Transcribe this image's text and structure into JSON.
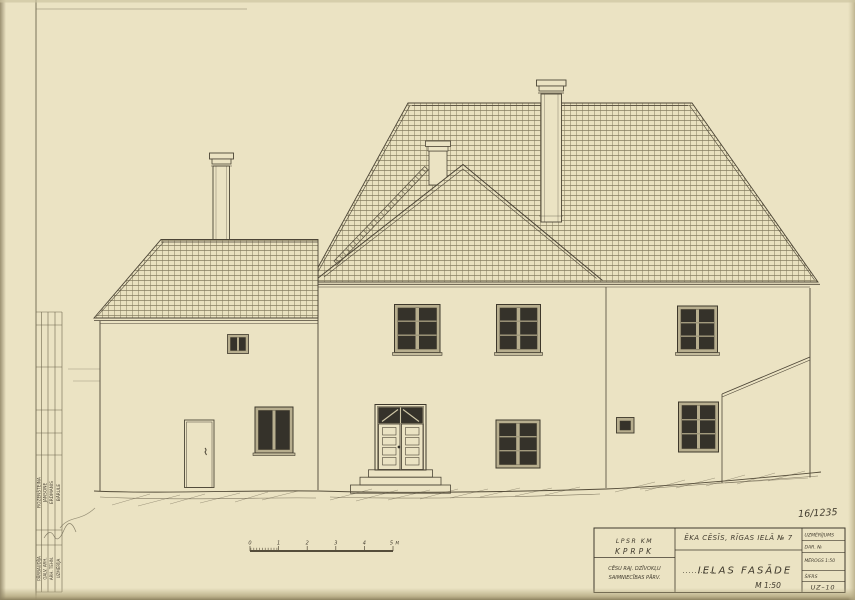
{
  "sheet": {
    "pencil_note": "16/1235"
  },
  "stamp_strip": {
    "role_labels": [
      "PĀRBAUDĪJA",
      "GALV. ARH.",
      "ARH. TEHN.",
      "UZMĒRĪJA"
    ],
    "names": [
      "ROZENŠTEINA",
      "JANSONE",
      "ERDMANIS",
      "BĀRULE"
    ]
  },
  "scalebar": {
    "labels": [
      "0",
      "1",
      "2",
      "3",
      "4",
      "5"
    ],
    "unit": "M"
  },
  "title_block": {
    "org_line1": "LPSR KM",
    "org_line2": "KPRPK",
    "org_line3": "CĒSU RAJ. DZĪVOKĻU",
    "org_line4": "SAIMNIECĪBAS PĀRV.",
    "project": "ĒKA CĒSĪS, RĪGAS IELĀ № 7",
    "drawing_title": "IELAS FASĀDE",
    "scale": "M 1:50",
    "col_labels": [
      "UZMĒRĪJUMS",
      "DAR. №",
      "MĒROGS 1:50",
      "ŠIFRS"
    ],
    "sheet_code": "UZ–10"
  },
  "colors": {
    "paper": "#ebe3c3",
    "ink": "#4c4536",
    "glass": "#35322a",
    "frame": "#b7ae8e"
  }
}
